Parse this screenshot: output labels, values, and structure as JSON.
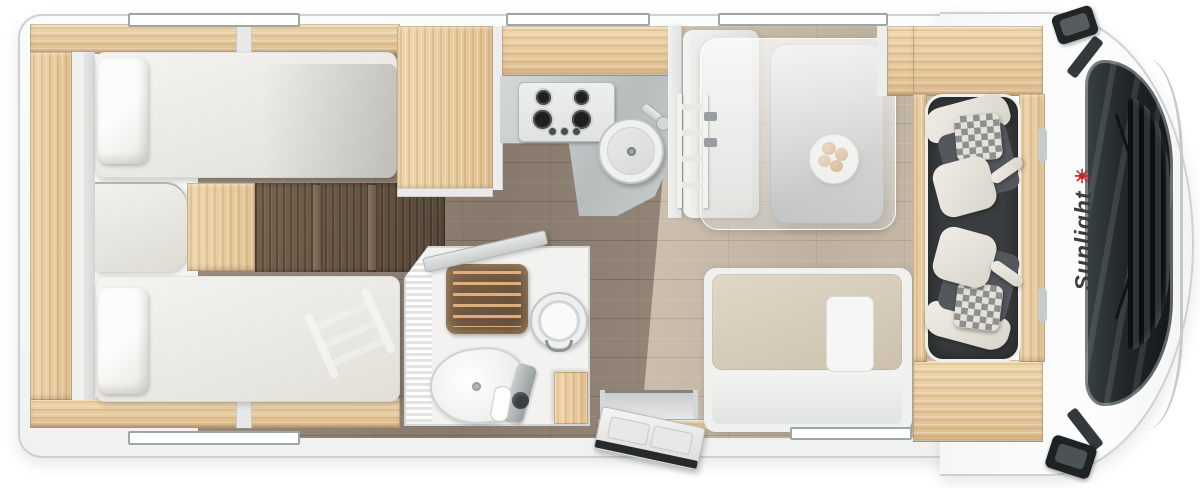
{
  "brand": {
    "name": "Sunlight",
    "icon": "sun-icon",
    "icon_glyph": "☀",
    "text_color": "#3c3c3e",
    "accent_color": "#cf1f26"
  },
  "vehicle": {
    "type": "motorhome",
    "view": "top-down-floor-plan"
  },
  "palette": {
    "body_white": "#fafbfb",
    "outline_gray": "#ccd1d1",
    "wood_light": "#e9cfa2",
    "wood_dark_walnut": "#6e5c4b",
    "floor_corridor": "#93857a",
    "floor_dinette": "#c9bcab",
    "mattress_cream": "#efeeea",
    "counter_gray": "#bfc5c5",
    "bench_beige": "#d8cfc0",
    "cab_floor_dark": "#3a3d3f",
    "glass_dark": "#20262a"
  },
  "areas": {
    "rear_bedroom": {
      "features": [
        "twin-single-beds",
        "pillows",
        "center-step-chest",
        "side-shelf",
        "overhead-lockers"
      ]
    },
    "midship": {
      "features": [
        "wardrobe",
        "gas-hob",
        "round-sink",
        "kitchen-counter"
      ]
    },
    "bathroom": {
      "features": [
        "shower-teak-grate",
        "cassette-toilet",
        "washbasin",
        "shower-mixer",
        "corner-cabinet",
        "open-door"
      ]
    },
    "entrance": {
      "features": [
        "entry-door-open",
        "wood-threshold"
      ]
    },
    "dinette": {
      "features": [
        "side-bench",
        "travel-bench",
        "pedestal-table",
        "plate-with-rolls",
        "drop-down-bed-overlay",
        "bed-ladder"
      ]
    },
    "cab": {
      "features": [
        "swivel-seat-top",
        "swivel-seat-bottom",
        "checkered-cushions",
        "windshield",
        "front-grille",
        "wing-mirror-top",
        "wing-mirror-bottom",
        "door-handles"
      ]
    }
  }
}
